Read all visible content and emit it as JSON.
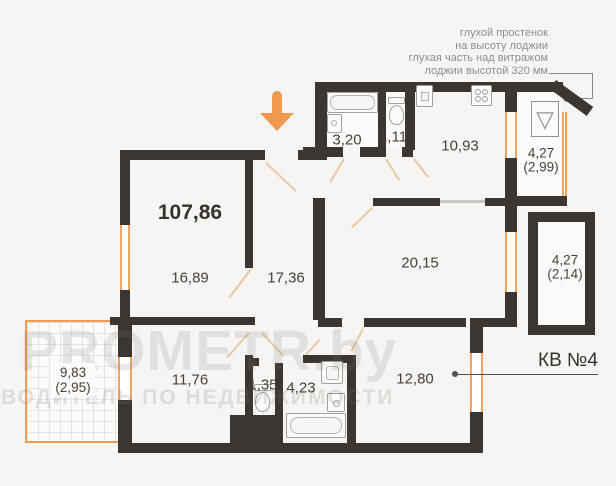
{
  "annotation": {
    "lines": [
      "глухой простенок",
      "на высоту лоджии",
      "глухая часть над витражом",
      "лоджии высотой 320 мм"
    ]
  },
  "apartment": {
    "total_area": "107,86",
    "unit_label": "КВ №4",
    "rooms": [
      {
        "id": "bathroom-top",
        "area": "3,20"
      },
      {
        "id": "wc-top",
        "area": "1,11"
      },
      {
        "id": "kitchen",
        "area": "10,93"
      },
      {
        "id": "loggia-top",
        "area": "4,27",
        "reduced_area": "(2,99)"
      },
      {
        "id": "room-left",
        "area": "16,89"
      },
      {
        "id": "hallway",
        "area": "17,36"
      },
      {
        "id": "living-room",
        "area": "20,15"
      },
      {
        "id": "loggia-right",
        "area": "4,27",
        "reduced_area": "(2,14)"
      },
      {
        "id": "terrace",
        "area": "9,83",
        "reduced_area": "(2,95)"
      },
      {
        "id": "room-bottom-left",
        "area": "11,76"
      },
      {
        "id": "wc-bottom",
        "area": "1,35"
      },
      {
        "id": "bathroom-bottom",
        "area": "4,23"
      },
      {
        "id": "room-bottom-right",
        "area": "12,80"
      }
    ]
  },
  "watermark": {
    "brand": "PROMETR.by",
    "slogan": "ПУТЕВОДИТЕЛЬ ПО НЕДВИЖИМОСТИ"
  },
  "colors": {
    "wall": "#3b3632",
    "accent_orange": "#f09a50",
    "window_orange": "#efa563",
    "muted_text": "#918e8a",
    "dark_text": "#36322d",
    "background": "#f6f5f3"
  }
}
